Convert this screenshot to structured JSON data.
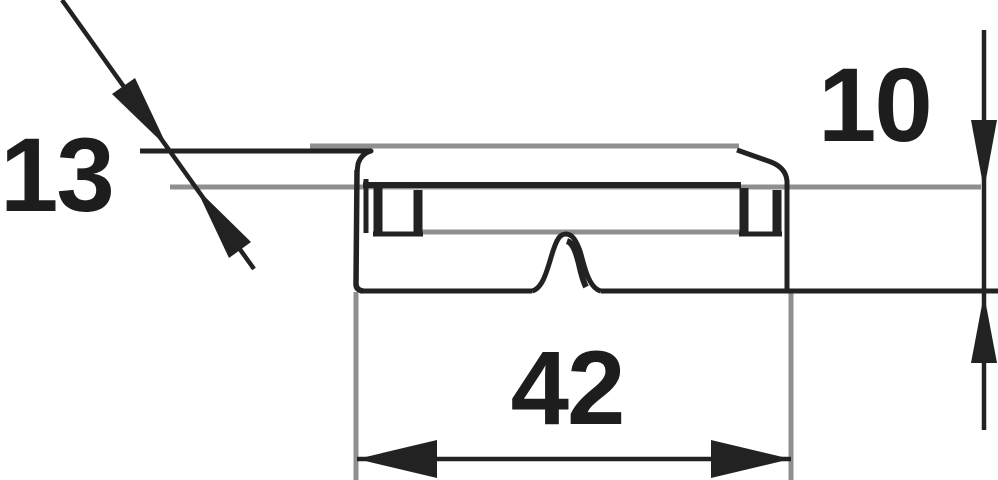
{
  "drawing": {
    "kind": "technical-dimension-drawing",
    "background": "#ffffff",
    "colors": {
      "part_outline": "#222222",
      "reference_lines": "#8f8f8f",
      "dimension_text": "#1d1d1d"
    },
    "dimensions": {
      "d13": {
        "value": "13"
      },
      "d10": {
        "value": "10"
      },
      "d42": {
        "value": "42"
      }
    }
  }
}
